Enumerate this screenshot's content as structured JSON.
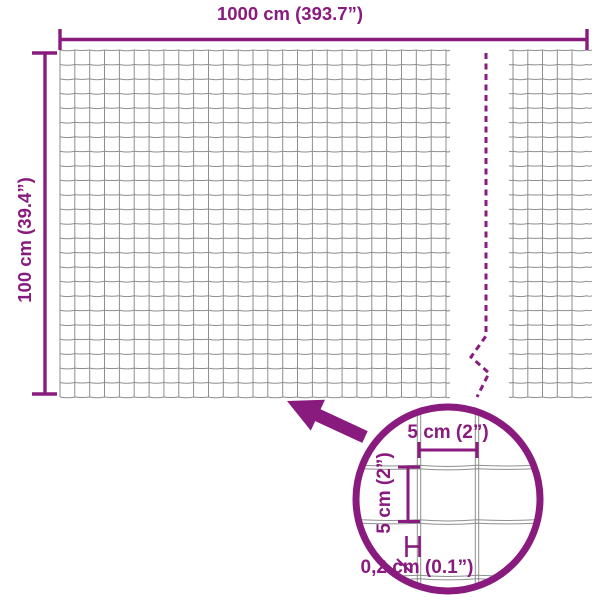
{
  "title": "Wire mesh fence dimension diagram",
  "colors": {
    "accent": "#891B7E",
    "wire": "#8E8E8E",
    "background": "#FFFFFF"
  },
  "dimensions": {
    "width_label": "1000 cm (393.7”)",
    "height_label": "100 cm (39.4”)"
  },
  "detail": {
    "cell_width_label": "5 cm (2”)",
    "cell_height_label": "5 cm (2”)",
    "wire_thickness_label": "0,2 cm (0.1”)"
  },
  "icons": {
    "zoom_arrow": "arrow-up-left",
    "magnifier": "detail-circle"
  }
}
